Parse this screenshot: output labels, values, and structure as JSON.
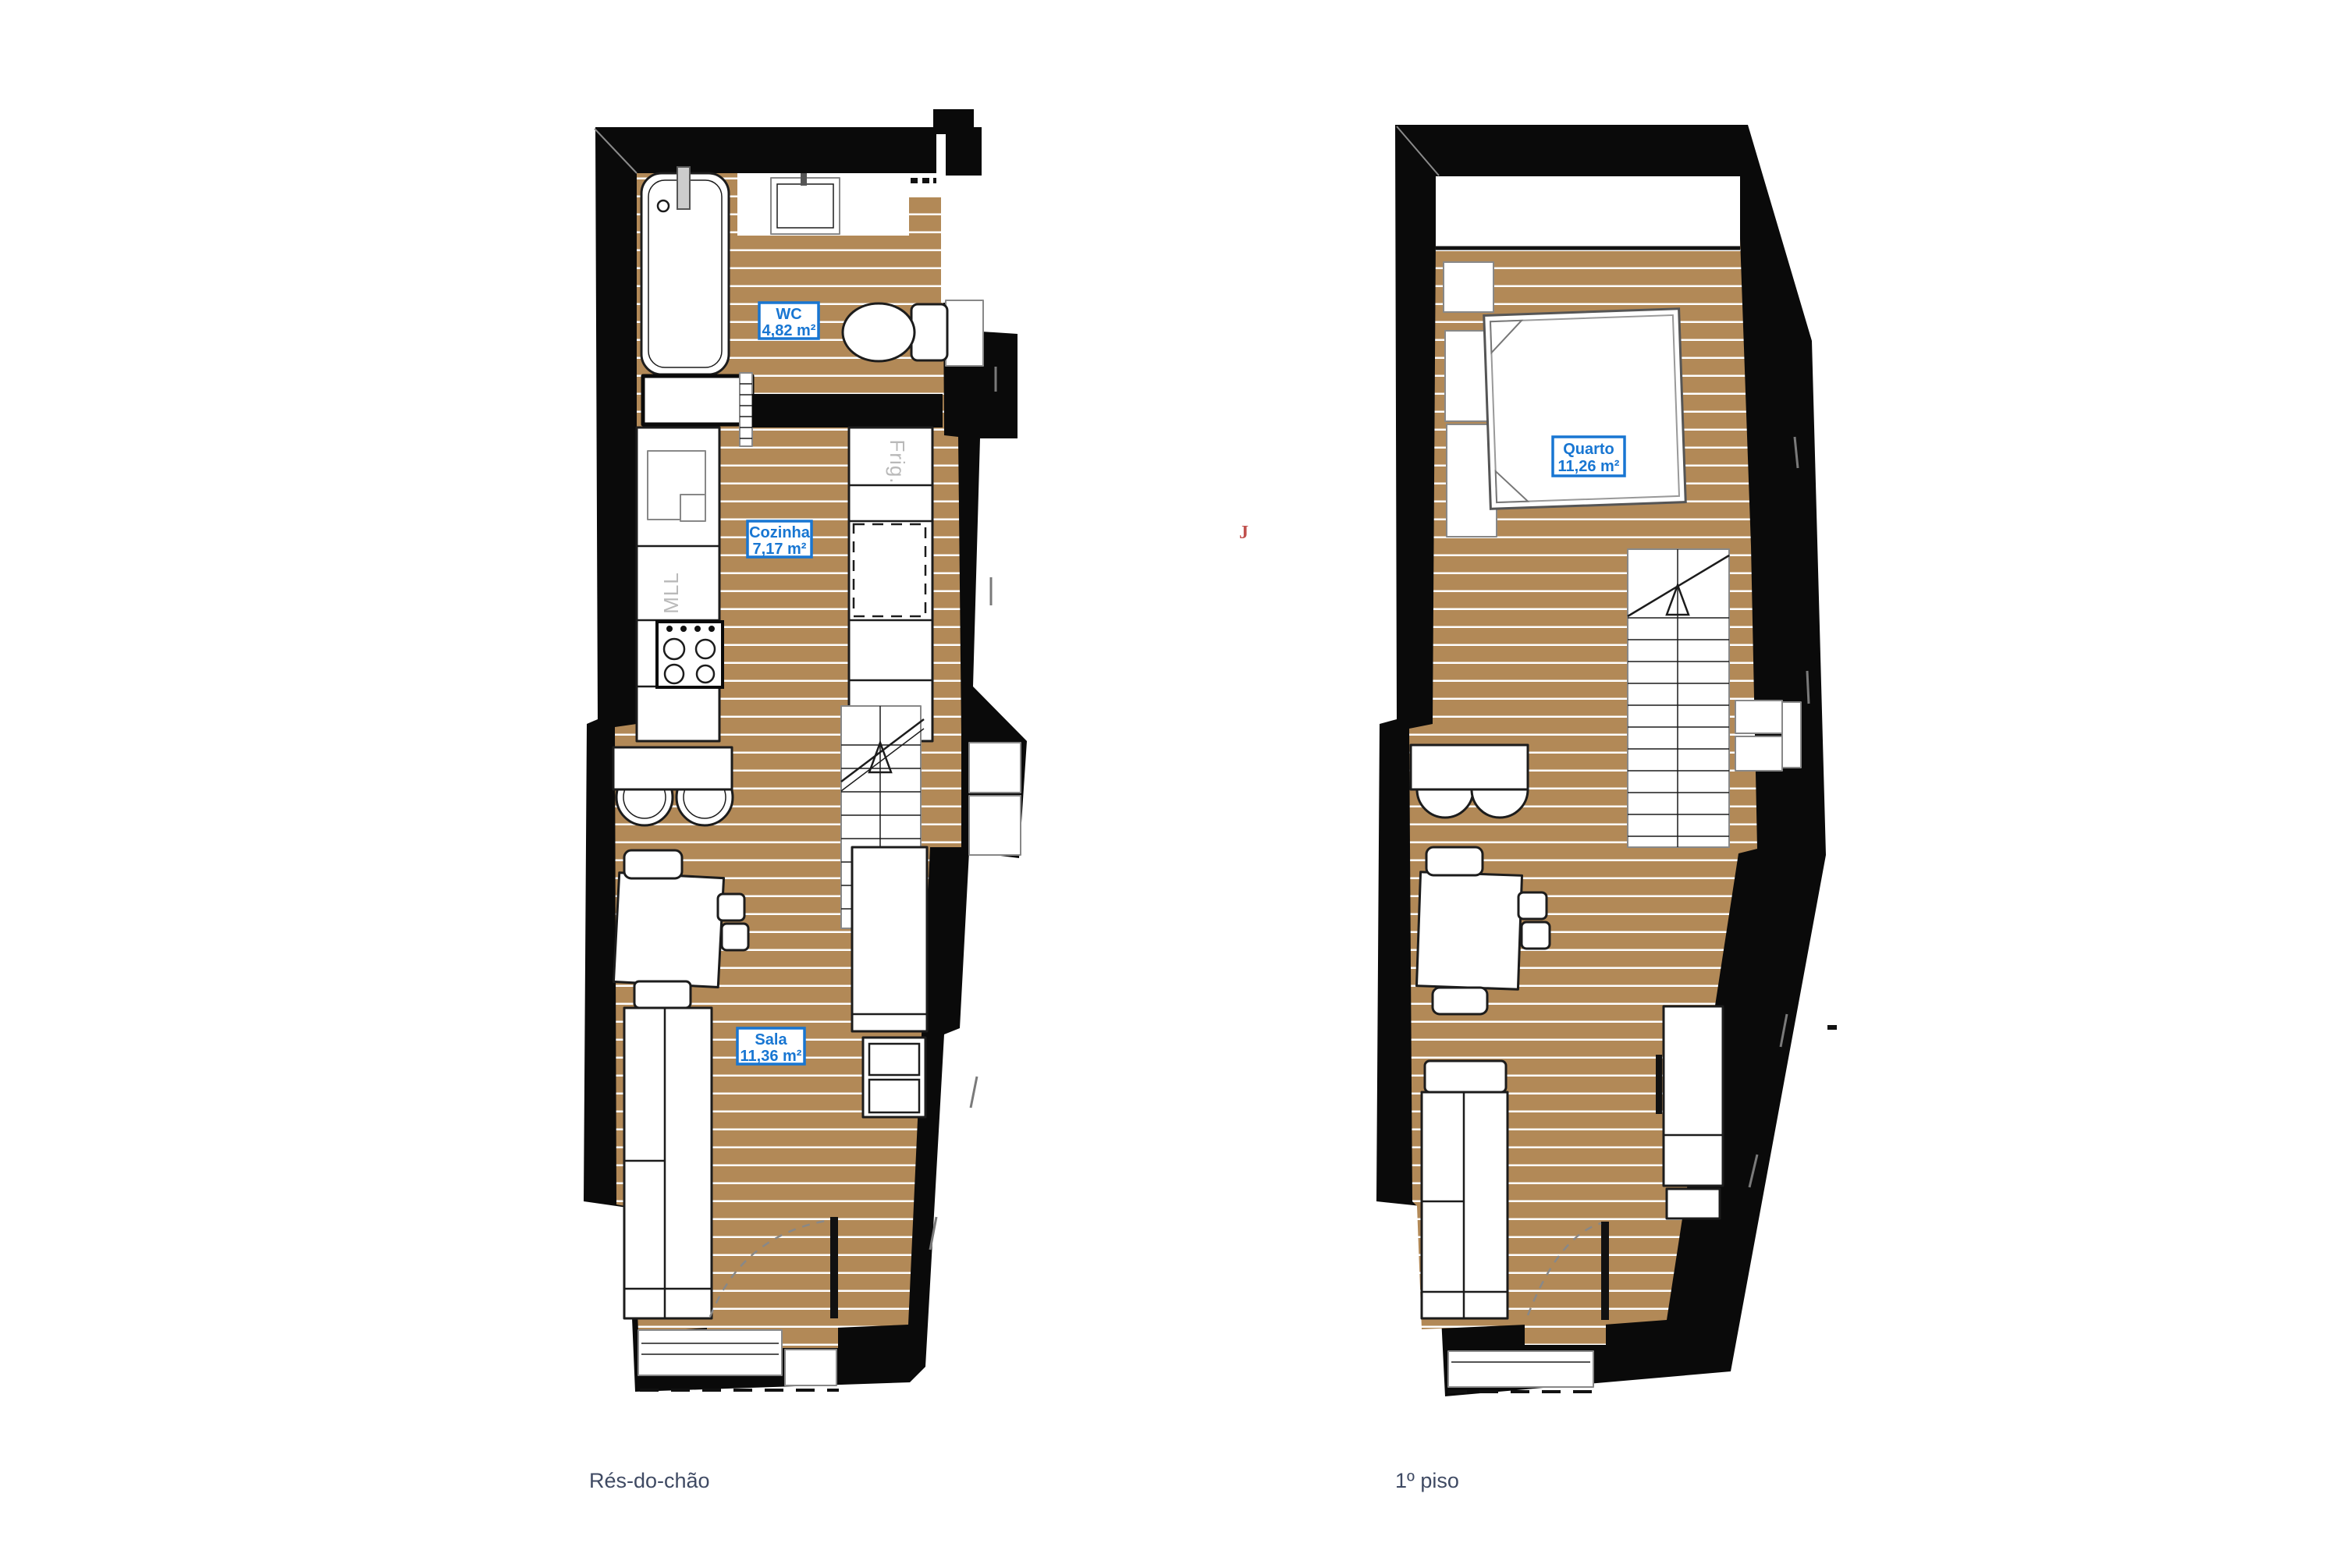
{
  "page": {
    "background": "#ffffff",
    "type": "architectural floor plan drawing"
  },
  "captions": {
    "left": "Rés-do-chão",
    "right": "1º piso"
  },
  "rooms": [
    {
      "name": "WC",
      "area": "4,82 m²"
    },
    {
      "name": "Cozinha",
      "area": "7,17 m²"
    },
    {
      "name": "Sala",
      "area": "11,36 m²"
    },
    {
      "name": "Quarto",
      "area": "11,26 m²"
    }
  ],
  "appliances": {
    "fridge": "Frig.",
    "dishwasher": "MLL"
  },
  "artifacts": {
    "red_mark": "J"
  },
  "colors": {
    "floor": "#b28957",
    "plank_line": "#ffffff",
    "wall": "#0a0a0a",
    "label_blue": "#1876d2",
    "caption_text": "#3f4a63",
    "appliance_text": "#b9b9b9",
    "red_mark": "#c0504d"
  }
}
